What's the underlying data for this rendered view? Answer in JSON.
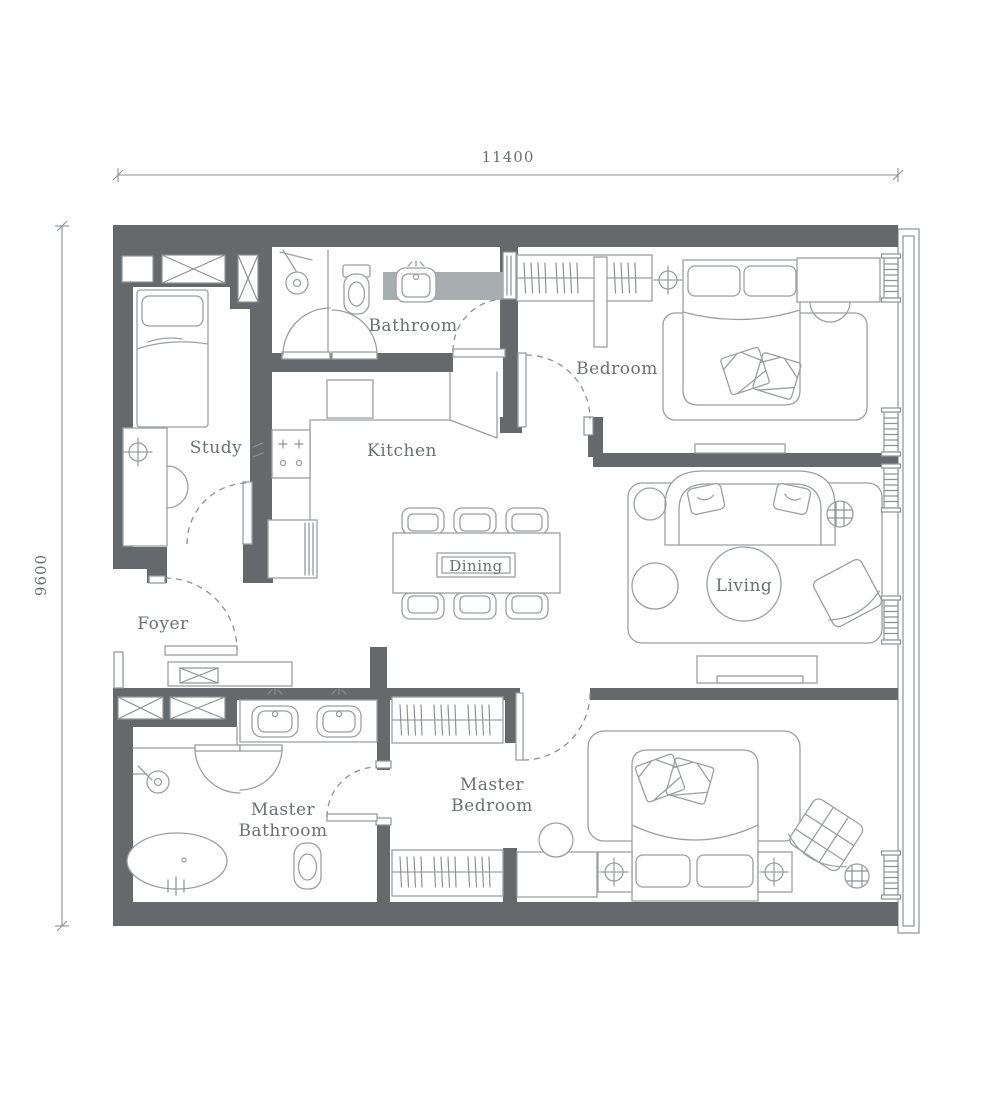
{
  "floorplan": {
    "dimension_top": "11400",
    "dimension_left": "9600",
    "rooms": {
      "study": "Study",
      "bathroom": "Bathroom",
      "kitchen": "Kitchen",
      "bedroom": "Bedroom",
      "dining": "Dining",
      "living": "Living",
      "foyer": "Foyer",
      "master_bathroom": [
        "Master",
        "Bathroom"
      ],
      "master_bedroom": [
        "Master",
        "Bedroom"
      ]
    },
    "colors": {
      "wall": "#66696c",
      "furniture": "#9b9fa2",
      "fixture": "#8d9296",
      "text": "#6b7073",
      "counter": "#a8adb0",
      "background": "#ffffff"
    }
  }
}
